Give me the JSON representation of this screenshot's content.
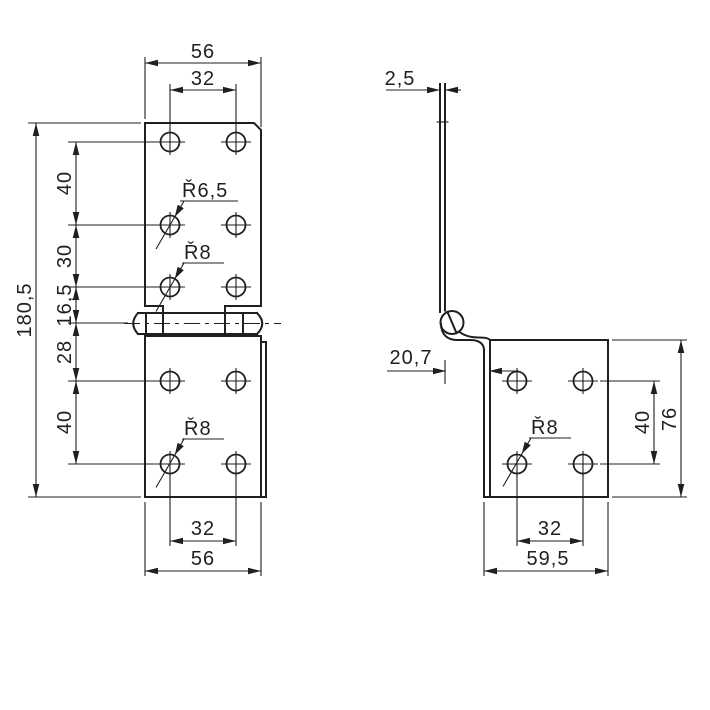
{
  "title": "hinge-technical-drawing",
  "colors": {
    "background": "#ffffff",
    "ink": "#1f1f1f"
  },
  "front": {
    "width_top": "56",
    "hole_spacing_top": "32",
    "total_height": "180,5",
    "seg_top": "40",
    "seg_mid": "30",
    "seg_pin": "16,5",
    "seg_below_pin": "28",
    "seg_bottom": "40",
    "hole_spacing_bottom": "32",
    "width_bottom": "56",
    "radius_top": "Ř6,5",
    "radius_mid": "Ř8",
    "radius_bottom": "Ř8"
  },
  "side": {
    "thickness": "2,5",
    "offset": "20,7",
    "radius": "Ř8",
    "hole_spacing_vertical": "40",
    "height": "76",
    "hole_spacing_bottom": "32",
    "width_bottom": "59,5"
  }
}
